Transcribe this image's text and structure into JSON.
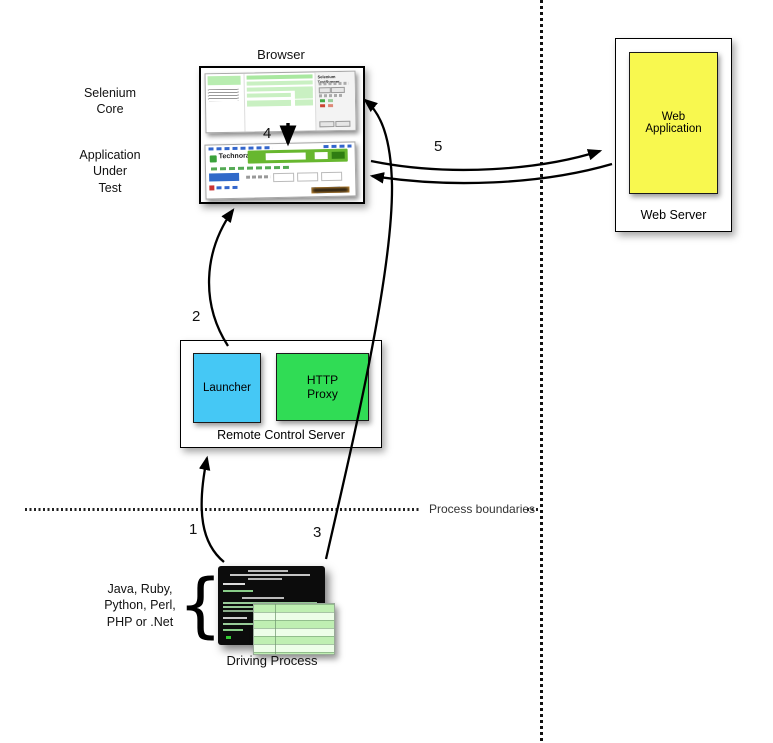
{
  "labels": {
    "browser": "Browser",
    "selenium_core": "Selenium\nCore",
    "application_under_test": "Application\nUnder\nTest",
    "web_application": "Web\nApplication",
    "web_server": "Web Server",
    "launcher": "Launcher",
    "http_proxy": "HTTP\nProxy",
    "remote_control_server": "Remote Control Server",
    "process_boundaries": "Process boundaries",
    "languages": "Java, Ruby,\nPython, Perl,\nPHP or .Net",
    "brace": "{",
    "driving_process": "Driving Process"
  },
  "steps": {
    "s1": "1",
    "s2": "2",
    "s3": "3",
    "s4": "4",
    "s5": "5"
  },
  "screenshots": {
    "testrunner_title": "Selenium TestRunner",
    "technorati_logo": "Technorati"
  },
  "colors": {
    "launcher_blue": "#45C8F5",
    "proxy_green": "#30DC55",
    "web_app_yellow": "#F8F84F"
  }
}
